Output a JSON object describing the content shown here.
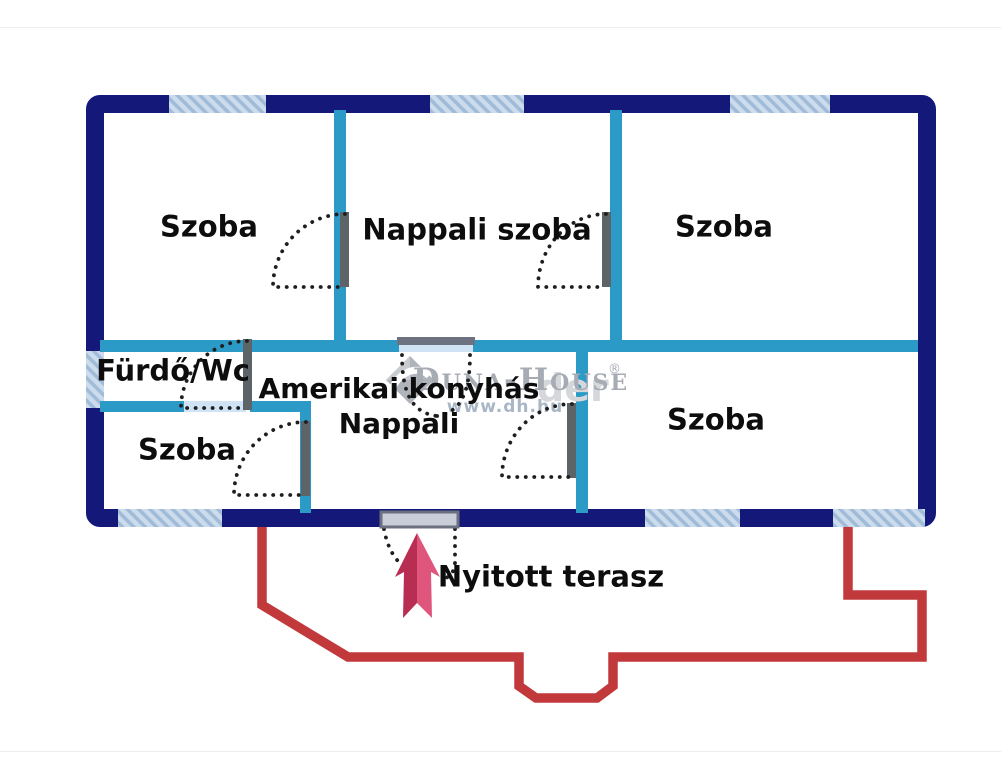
{
  "floorplan": {
    "rooms": [
      {
        "id": "szoba-top-left",
        "label": "Szoba"
      },
      {
        "id": "nappali-szoba",
        "label": "Nappali szoba"
      },
      {
        "id": "szoba-top-right",
        "label": "Szoba"
      },
      {
        "id": "furdo-wc",
        "label": "Fürdő/Wc"
      },
      {
        "id": "amerikai-konyhas-nappali",
        "lines": [
          "Amerikai konyhás",
          "Nappali"
        ]
      },
      {
        "id": "szoba-bottom-left",
        "label": "Szoba"
      },
      {
        "id": "szoba-bottom-right",
        "label": "Szoba"
      }
    ],
    "outdoor": {
      "label": "Nyitott terasz"
    },
    "watermark": {
      "brand": "Duna-House",
      "registered": "®",
      "url": "www.dh.hu",
      "ghost_text": "der"
    },
    "icons": {
      "entrance_arrow": "entrance-direction-arrow",
      "logo_diamond": "duna-house-diamond-logo"
    },
    "colors": {
      "outer_wall": "#131879",
      "inner_wall": "#2b9ac6",
      "window_fill": "#ccdcec",
      "window_stripe": "#9fbbd8",
      "door_opening": "#cfe3f4",
      "door_leaf": "#5d6467",
      "door_arc_dots": "#1e1e1e",
      "terrace_line": "#c2393b",
      "arrow_dark": "#b72e52",
      "arrow_light": "#e0557c",
      "label_text": "#0d0d0d",
      "watermark_gray": "#a6abb4"
    }
  }
}
